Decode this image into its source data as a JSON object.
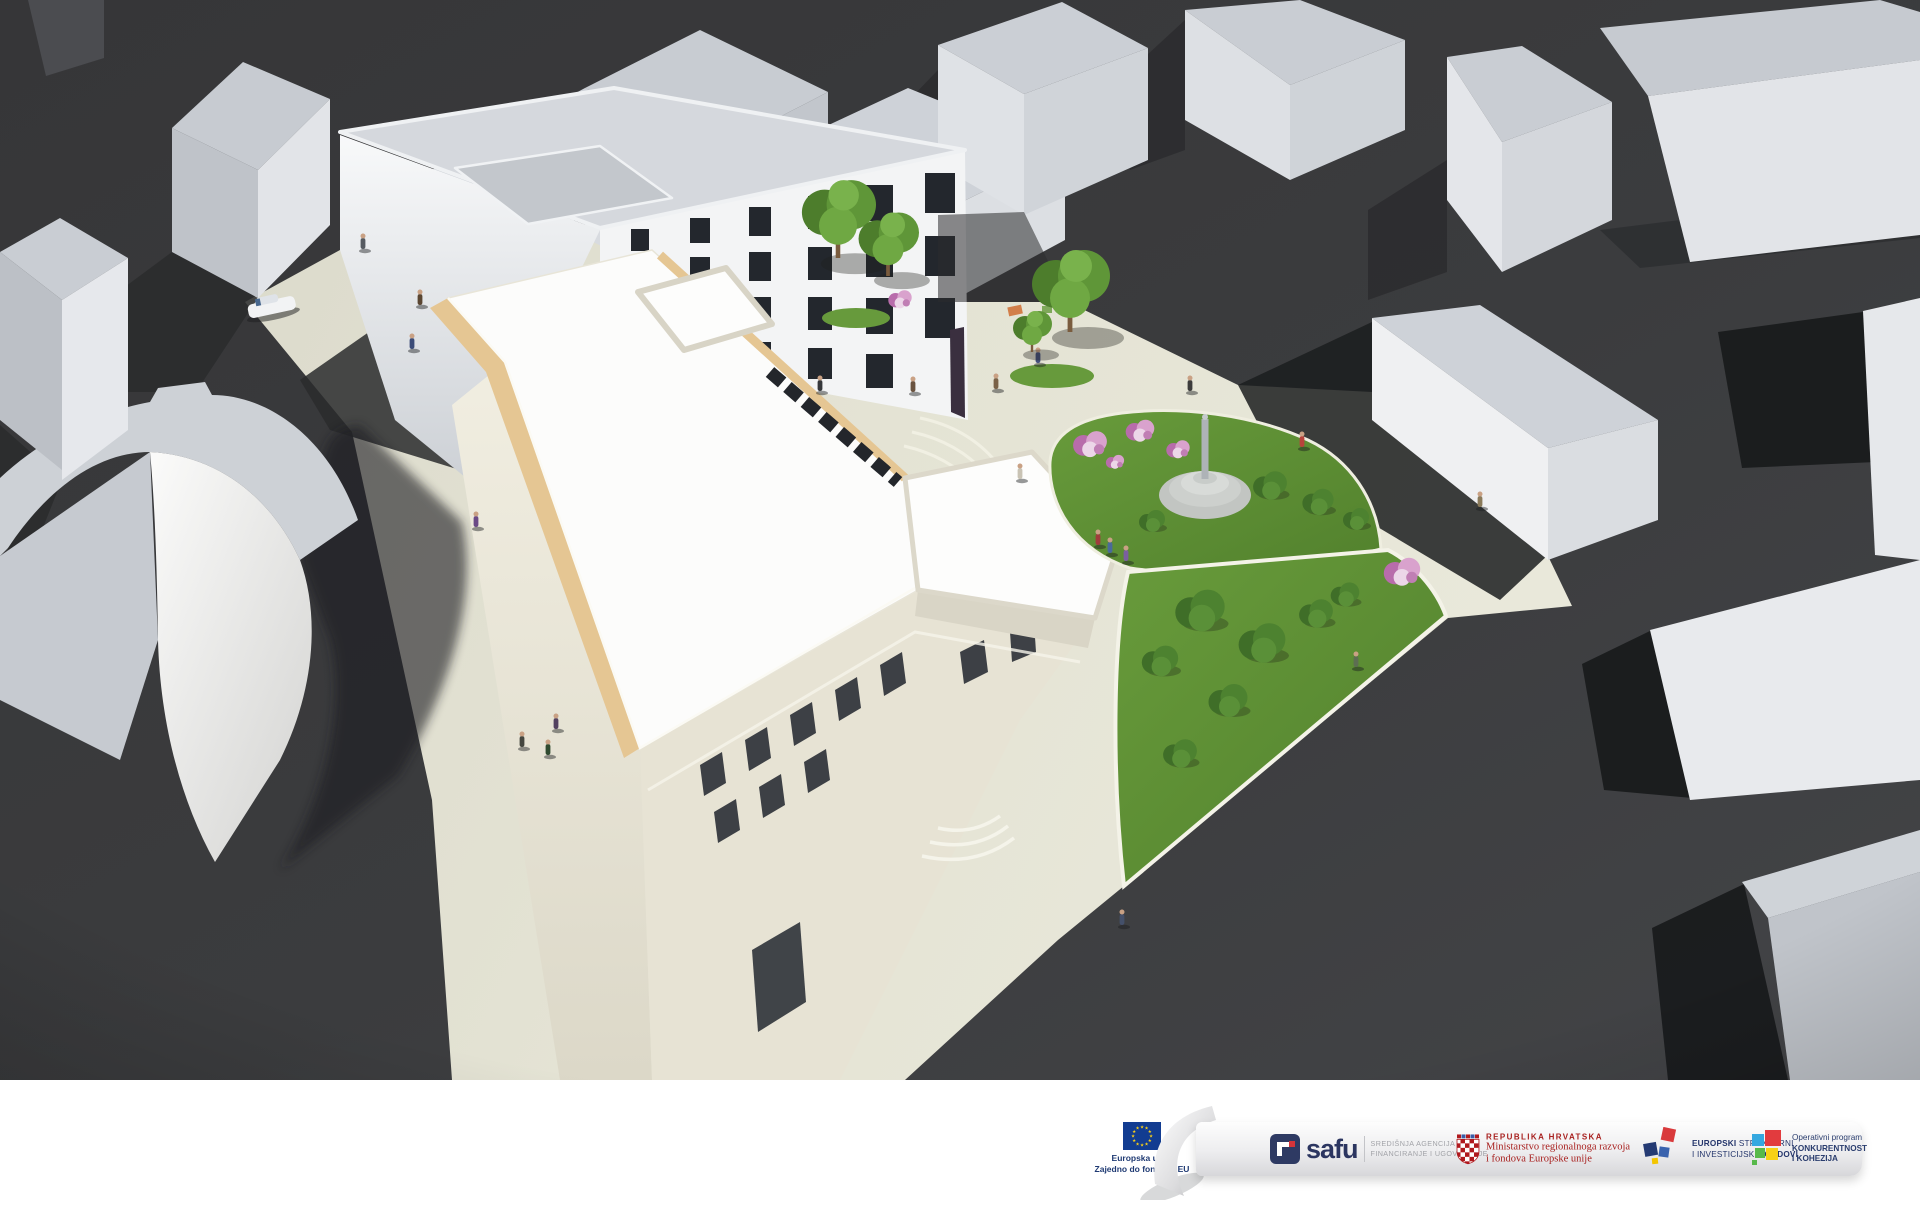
{
  "banner": {
    "eu_logo": {
      "line1": "Europska unija",
      "line2": "Zajedno do fondova EU"
    },
    "safu": {
      "name": "safu",
      "agency_line1": "SREDIŠNJA AGENCIJA ZA",
      "agency_line2": "FINANCIRANJE I UGOVARANJE"
    },
    "croatia": {
      "line1": "REPUBLIKA HRVATSKA",
      "line2": "Ministarstvo regionalnoga razvoja",
      "line3": "i fondova Europske unije"
    },
    "eu_funds": {
      "line1_bold": "EUROPSKI",
      "line1_rest": " STRUKTURNI",
      "line2_pre": "I INVESTICIJSKI ",
      "line2_bold": "FONDOVI"
    },
    "opkk": {
      "line1": "Operativni program",
      "line2": "KONKURENTNOST",
      "line3": "I KOHEZIJA"
    }
  },
  "colors": {
    "ground_dark": "#3b3c3e",
    "plaza_beige": "#e2e1d2",
    "roof_white": "#fcfcfb",
    "cornice_tan": "#e5c693",
    "lawn_green": "#5f9136",
    "eu_flag_blue": "#123c91",
    "eu_star_yellow": "#fcd116",
    "safu_navy": "#2b3560",
    "croatia_red": "#a8201f",
    "funds_navy": "#24356b",
    "opkk_red": "#e23b3e",
    "opkk_blue": "#35a8e0",
    "opkk_green": "#58b94b",
    "opkk_yellow": "#f7d117"
  }
}
